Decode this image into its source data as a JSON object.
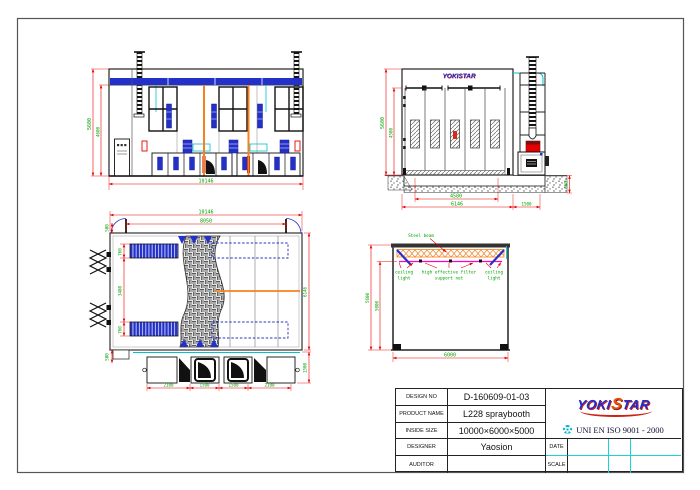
{
  "colors": {
    "dimension_line": "#e60000",
    "dimension_text": "#00a000",
    "drawing_line": "#222222",
    "blue": "#2331c8",
    "cyan": "#00c3cf",
    "orange": "#f5821f",
    "magenta": "#ff00cc",
    "logo_blue": "#1b2ed8",
    "logo_red": "#cc2211"
  },
  "front_view": {
    "dim_height_outer": "5600",
    "dim_height_inner": "4600",
    "dim_width": "10146"
  },
  "side_view": {
    "logo_text": "YOKISTAR",
    "dim_height_outer": "5600",
    "dim_height_inner": "4500",
    "dim_doors": "4580",
    "dim_width": "6146",
    "dim_right": "1500",
    "dim_pit": "650"
  },
  "plan_view": {
    "dim_width_total": "10146",
    "dim_width_inner": "8050",
    "dim_door_offset": "500",
    "dim_strip_top": "760",
    "dim_mid": "3480",
    "dim_strip_bottom": "760",
    "dim_corner": "500",
    "dim_depth": "6146",
    "dim_fan_right": "1500",
    "dim_bottom_1": "2100",
    "dim_bottom_2": "1500",
    "dim_bottom_3": "1500",
    "dim_bottom_4": "2100"
  },
  "section_view": {
    "label_steel_beam": "Steel beam",
    "label_ceiling_left_1": "ceiling",
    "label_ceiling_left_2": "light",
    "label_filter_1": "high effective filter",
    "label_filter_2": "support net",
    "label_ceiling_right_1": "ceiling",
    "label_ceiling_right_2": "light",
    "dim_height_outer": "5600",
    "dim_height_inner": "5000",
    "dim_width": "6000"
  },
  "title_block": {
    "design_no_label": "DESIGN NO",
    "design_no": "D-160609-01-03",
    "product_name_label": "PRODUCT NAME",
    "product_name": "L228 spraybooth",
    "inside_size_label": "INSIDE SIZE",
    "inside_size": "10000×6000×5000",
    "designer_label": "DESIGNER",
    "designer": "Yaosion",
    "auditor_label": "AUDITOR",
    "auditor": "",
    "date_label": "DATE",
    "date": "",
    "scale_label": "SCALE",
    "scale": "",
    "logo_part1": "YOKI",
    "logo_part2": "S",
    "logo_part3": "TAR",
    "iso_text": "UNI EN ISO 9001 - 2000"
  }
}
